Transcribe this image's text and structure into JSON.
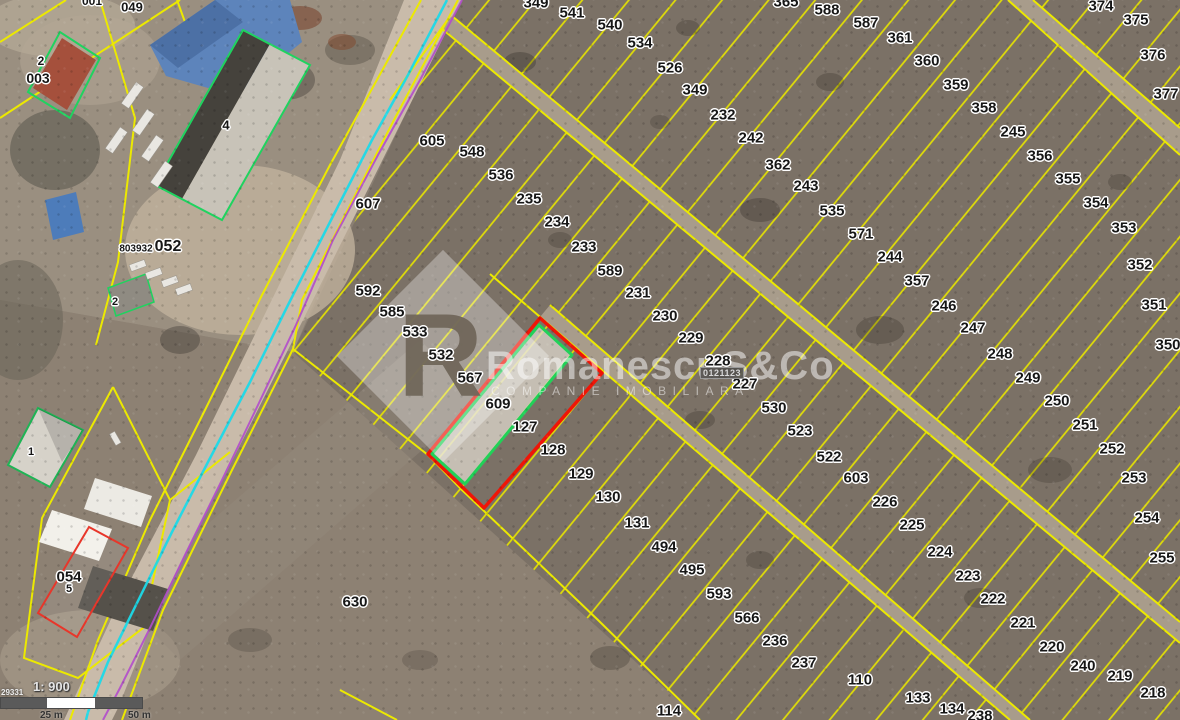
{
  "watermark": {
    "logo_letter": "R",
    "brand": "RomanescuS&Co",
    "tagline": "COMPANIE IMOBILIARĂ"
  },
  "scale": {
    "ratio_label": "1: 900",
    "ref_number": "29331",
    "tick_25": "25 m",
    "tick_50": "50 m"
  },
  "highlight": {
    "parcel_badge": "0121123",
    "outline_color": "#ef1507",
    "inner_outline_color": "#21d158"
  },
  "colors": {
    "parcel_line": "#e8e500",
    "road_line_cyan": "#1cd9e8",
    "road_line_purple": "#b14ccb",
    "building_outline_green": "#1fd35f",
    "building_outline_red": "#e8362a"
  },
  "map": {
    "labels": [
      {
        "t": "349",
        "x": 536,
        "y": 3
      },
      {
        "t": "365",
        "x": 786,
        "y": 2
      },
      {
        "t": "541",
        "x": 572,
        "y": 13
      },
      {
        "t": "540",
        "x": 610,
        "y": 25
      },
      {
        "t": "534",
        "x": 640,
        "y": 43
      },
      {
        "t": "526",
        "x": 670,
        "y": 68
      },
      {
        "t": "349",
        "x": 695,
        "y": 90
      },
      {
        "t": "232",
        "x": 723,
        "y": 115
      },
      {
        "t": "242",
        "x": 751,
        "y": 138
      },
      {
        "t": "362",
        "x": 778,
        "y": 165
      },
      {
        "t": "243",
        "x": 806,
        "y": 186
      },
      {
        "t": "535",
        "x": 832,
        "y": 211
      },
      {
        "t": "571",
        "x": 861,
        "y": 234
      },
      {
        "t": "244",
        "x": 890,
        "y": 257
      },
      {
        "t": "357",
        "x": 917,
        "y": 281
      },
      {
        "t": "246",
        "x": 944,
        "y": 306
      },
      {
        "t": "247",
        "x": 973,
        "y": 328
      },
      {
        "t": "248",
        "x": 1000,
        "y": 354
      },
      {
        "t": "249",
        "x": 1028,
        "y": 378
      },
      {
        "t": "250",
        "x": 1057,
        "y": 401
      },
      {
        "t": "251",
        "x": 1085,
        "y": 425
      },
      {
        "t": "252",
        "x": 1112,
        "y": 449
      },
      {
        "t": "253",
        "x": 1134,
        "y": 478
      },
      {
        "t": "254",
        "x": 1147,
        "y": 518
      },
      {
        "t": "255",
        "x": 1162,
        "y": 558
      },
      {
        "t": "588",
        "x": 827,
        "y": 10
      },
      {
        "t": "587",
        "x": 866,
        "y": 23
      },
      {
        "t": "361",
        "x": 900,
        "y": 38
      },
      {
        "t": "360",
        "x": 927,
        "y": 61
      },
      {
        "t": "359",
        "x": 956,
        "y": 85
      },
      {
        "t": "358",
        "x": 984,
        "y": 108
      },
      {
        "t": "245",
        "x": 1013,
        "y": 132
      },
      {
        "t": "356",
        "x": 1040,
        "y": 156
      },
      {
        "t": "355",
        "x": 1068,
        "y": 179
      },
      {
        "t": "354",
        "x": 1096,
        "y": 203
      },
      {
        "t": "353",
        "x": 1124,
        "y": 228
      },
      {
        "t": "352",
        "x": 1140,
        "y": 265
      },
      {
        "t": "351",
        "x": 1154,
        "y": 305
      },
      {
        "t": "350",
        "x": 1168,
        "y": 345
      },
      {
        "t": "374",
        "x": 1101,
        "y": 6
      },
      {
        "t": "375",
        "x": 1136,
        "y": 20
      },
      {
        "t": "376",
        "x": 1153,
        "y": 55
      },
      {
        "t": "377",
        "x": 1166,
        "y": 94
      },
      {
        "t": "605",
        "x": 432,
        "y": 141
      },
      {
        "t": "548",
        "x": 472,
        "y": 152
      },
      {
        "t": "536",
        "x": 501,
        "y": 175
      },
      {
        "t": "235",
        "x": 529,
        "y": 199
      },
      {
        "t": "234",
        "x": 557,
        "y": 222
      },
      {
        "t": "233",
        "x": 584,
        "y": 247
      },
      {
        "t": "589",
        "x": 610,
        "y": 271
      },
      {
        "t": "231",
        "x": 638,
        "y": 293
      },
      {
        "t": "230",
        "x": 665,
        "y": 316
      },
      {
        "t": "229",
        "x": 691,
        "y": 338
      },
      {
        "t": "228",
        "x": 718,
        "y": 361
      },
      {
        "t": "227",
        "x": 745,
        "y": 384
      },
      {
        "t": "530",
        "x": 774,
        "y": 408
      },
      {
        "t": "523",
        "x": 800,
        "y": 431
      },
      {
        "t": "522",
        "x": 829,
        "y": 457
      },
      {
        "t": "603",
        "x": 856,
        "y": 478
      },
      {
        "t": "226",
        "x": 885,
        "y": 502
      },
      {
        "t": "225",
        "x": 912,
        "y": 525
      },
      {
        "t": "224",
        "x": 940,
        "y": 552
      },
      {
        "t": "223",
        "x": 968,
        "y": 576
      },
      {
        "t": "222",
        "x": 993,
        "y": 599
      },
      {
        "t": "221",
        "x": 1023,
        "y": 623
      },
      {
        "t": "220",
        "x": 1052,
        "y": 647
      },
      {
        "t": "240",
        "x": 1083,
        "y": 666
      },
      {
        "t": "219",
        "x": 1120,
        "y": 676
      },
      {
        "t": "218",
        "x": 1153,
        "y": 693
      },
      {
        "t": "607",
        "x": 368,
        "y": 204
      },
      {
        "t": "592",
        "x": 368,
        "y": 291
      },
      {
        "t": "585",
        "x": 392,
        "y": 312
      },
      {
        "t": "533",
        "x": 415,
        "y": 332
      },
      {
        "t": "532",
        "x": 441,
        "y": 355
      },
      {
        "t": "567",
        "x": 470,
        "y": 378
      },
      {
        "t": "609",
        "x": 498,
        "y": 404
      },
      {
        "t": "127",
        "x": 525,
        "y": 427
      },
      {
        "t": "128",
        "x": 553,
        "y": 450
      },
      {
        "t": "129",
        "x": 581,
        "y": 474
      },
      {
        "t": "130",
        "x": 608,
        "y": 497
      },
      {
        "t": "131",
        "x": 637,
        "y": 523
      },
      {
        "t": "494",
        "x": 664,
        "y": 547
      },
      {
        "t": "495",
        "x": 692,
        "y": 570
      },
      {
        "t": "593",
        "x": 719,
        "y": 594
      },
      {
        "t": "566",
        "x": 747,
        "y": 618
      },
      {
        "t": "236",
        "x": 775,
        "y": 641
      },
      {
        "t": "237",
        "x": 804,
        "y": 663
      },
      {
        "t": "110",
        "x": 860,
        "y": 680
      },
      {
        "t": "114",
        "x": 669,
        "y": 711
      },
      {
        "t": "133",
        "x": 918,
        "y": 698
      },
      {
        "t": "134",
        "x": 952,
        "y": 709
      },
      {
        "t": "238",
        "x": 980,
        "y": 716
      },
      {
        "t": "630",
        "x": 355,
        "y": 602
      },
      {
        "t": "001",
        "x": 92,
        "y": 1,
        "s": 12
      },
      {
        "t": "049",
        "x": 132,
        "y": 7,
        "s": 13
      },
      {
        "t": "2",
        "x": 41,
        "y": 61,
        "s": 12
      },
      {
        "t": "003",
        "x": 38,
        "y": 78,
        "s": 14
      },
      {
        "t": "4",
        "x": 226,
        "y": 125,
        "s": 13
      },
      {
        "t": "803932",
        "x": 136,
        "y": 249,
        "s": 10
      },
      {
        "t": "052",
        "x": 168,
        "y": 247,
        "s": 16
      },
      {
        "t": "2",
        "x": 115,
        "y": 302,
        "s": 11
      },
      {
        "t": "1",
        "x": 31,
        "y": 452,
        "s": 11
      },
      {
        "t": "054",
        "x": 69,
        "y": 577,
        "s": 15
      },
      {
        "t": "5",
        "x": 69,
        "y": 589,
        "s": 11
      }
    ]
  }
}
